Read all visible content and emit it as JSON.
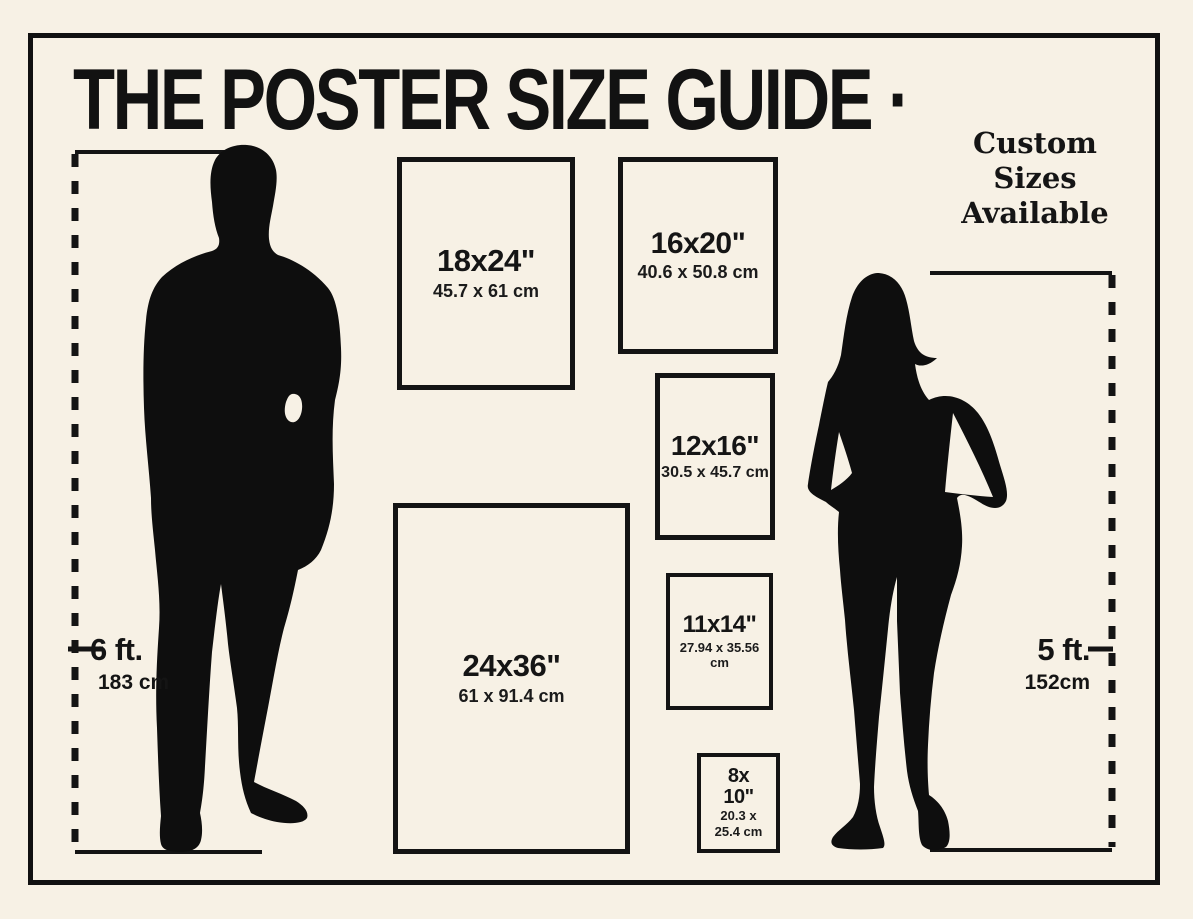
{
  "title": "THE POSTER SIZE GUIDE ·",
  "custom_note": {
    "text": "Custom Sizes Available"
  },
  "posters": [
    {
      "name": "poster-18x24",
      "size": "18x24\"",
      "metric": "45.7 x 61 cm"
    },
    {
      "name": "poster-16x20",
      "size": "16x20\"",
      "metric": "40.6 x 50.8 cm"
    },
    {
      "name": "poster-12x16",
      "size": "12x16\"",
      "metric": "30.5 x 45.7 cm"
    },
    {
      "name": "poster-24x36",
      "size": "24x36\"",
      "metric": "61 x 91.4 cm"
    },
    {
      "name": "poster-11x14",
      "size": "11x14\"",
      "metric": "27.94 x 35.56 cm"
    },
    {
      "name": "poster-8x10",
      "size_line1": "8x",
      "size_line2": "10\"",
      "metric_line1": "20.3 x",
      "metric_line2": "25.4 cm"
    }
  ],
  "measurements": {
    "male": {
      "feet": "6 ft.",
      "cm": "183 cm"
    },
    "female": {
      "feet": "5 ft.",
      "cm": "152cm"
    }
  },
  "figures": {
    "male": "man-silhouette",
    "female": "woman-silhouette"
  },
  "colors": {
    "background": "#f7f1e5",
    "ink": "#111111"
  }
}
